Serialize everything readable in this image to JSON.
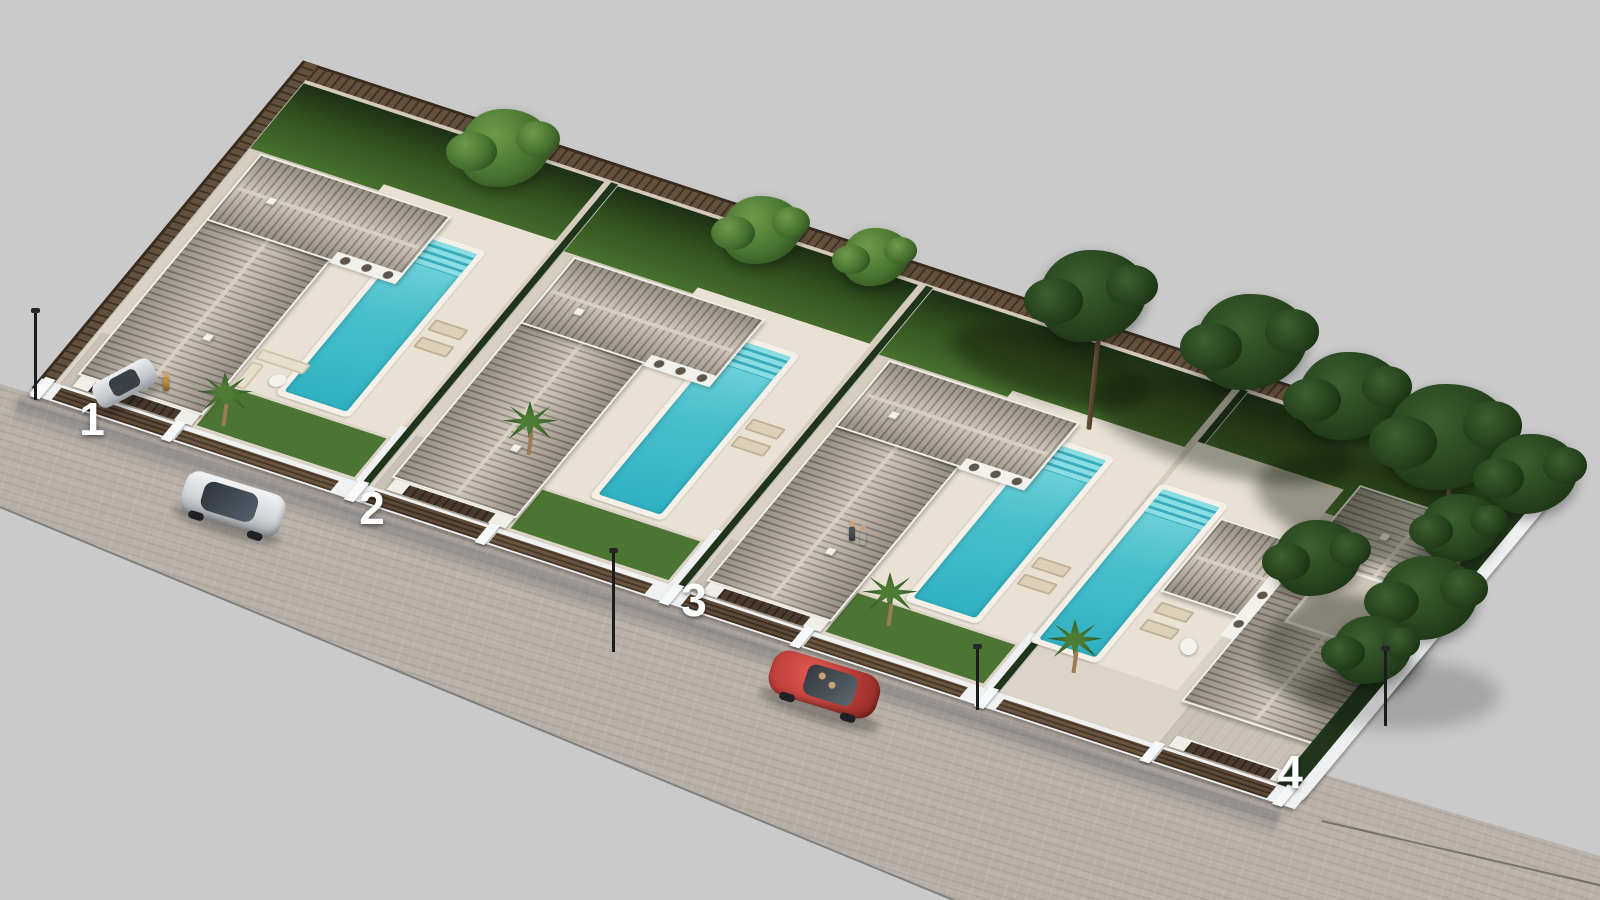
{
  "title": "Aerial 3D render of a row of four new-build villas with private pools",
  "scene": {
    "background_color": "#c9cac9",
    "street": {
      "pavement_color": "#b7b0a8",
      "curb_color": "#46423c"
    },
    "plots": [
      {
        "label": "1",
        "x": 92,
        "y": 419,
        "features": "villa, garage, driveway, private pool, garden, lounge set"
      },
      {
        "label": "2",
        "x": 372,
        "y": 508,
        "features": "villa, garage, driveway, private pool, garden"
      },
      {
        "label": "3",
        "x": 694,
        "y": 600,
        "features": "villa, garage, driveway, private pool, garden"
      },
      {
        "label": "4",
        "x": 1293,
        "y": 776,
        "features": "corner villa, garage, roof terrace, private pool, garden"
      }
    ],
    "vehicles": [
      {
        "type": "suv",
        "color": "silver",
        "location": "street in front of plot 1"
      },
      {
        "type": "sports-car",
        "color": "red",
        "location": "street in front of plot 3"
      },
      {
        "type": "hatchback",
        "color": "silver",
        "location": "driveway of plot 1"
      }
    ],
    "landscape": {
      "pool_color": "#49c0cc",
      "grass_color": "#47702d",
      "roof_color": "#c2b8a9",
      "fence_color": "#63503c",
      "boundary": "timber slat fence and white walls with slatted gates",
      "trees": "broadleaf and pine trees along rear and right boundaries, palms by terraces"
    }
  }
}
